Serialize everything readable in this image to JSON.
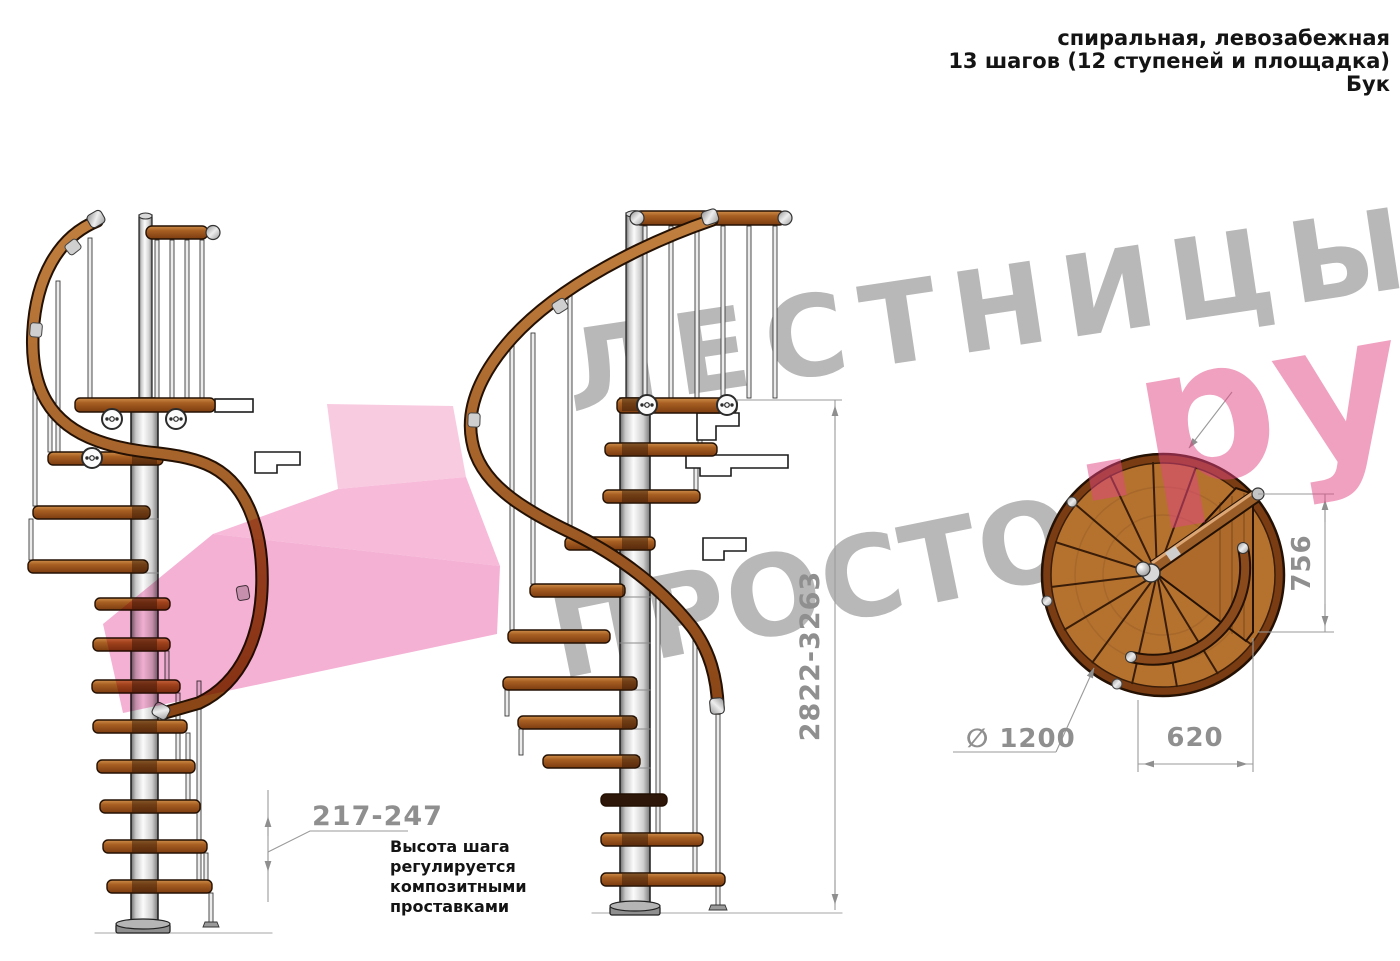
{
  "header": {
    "line1": "спиральная, левозабежная",
    "line2": "13 шагов (12 ступеней и площадка)",
    "line3": "Бук"
  },
  "watermark": {
    "word1": "ЛЕСТНИЦЫ",
    "word2": "ПРОСТО",
    "word3": ".ру"
  },
  "note": {
    "line1": "Высота шага",
    "line2": "регулируется",
    "line3": "композитными",
    "line4": "проставками"
  },
  "dimensions": {
    "total_height": "2822-3263",
    "step_height": "217-247",
    "diameter": "∅ 1200",
    "landing_width": "620",
    "landing_depth": "756"
  },
  "colors": {
    "wood": "#a05d24",
    "wood_dark": "#7a3c12",
    "metal": "#d9d9d9",
    "watermark_gray": "#7e7e7e",
    "watermark_pink": "#e24482",
    "arrow_pink": "#f4a9d0",
    "dimension_gray": "#8f8f8f"
  }
}
